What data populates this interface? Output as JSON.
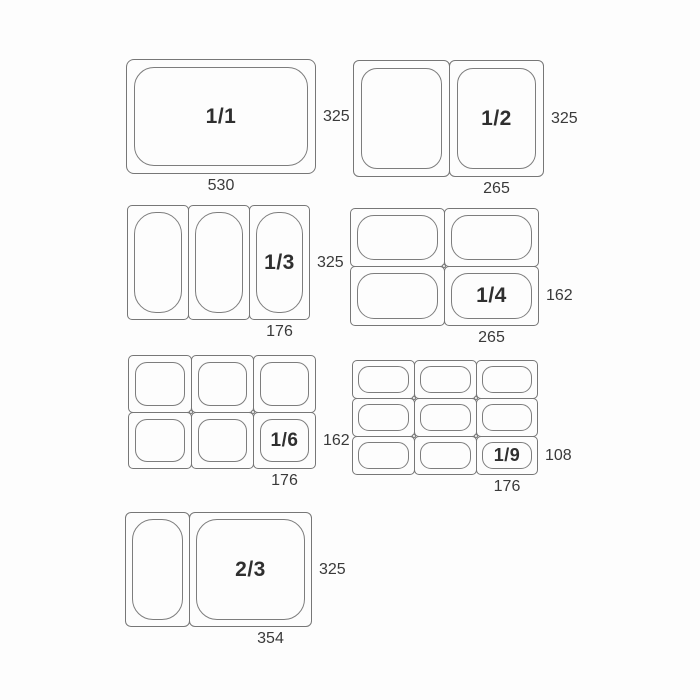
{
  "colors": {
    "line": "#777777",
    "label_text": "#2f2f2f",
    "dimension_text": "#3a3a3a",
    "background": "#fdfdfd"
  },
  "groups": [
    {
      "id": "1-1",
      "label": "1/1",
      "height_mm": "325",
      "width_mm": "530"
    },
    {
      "id": "1-2",
      "label": "1/2",
      "height_mm": "325",
      "width_mm": "265"
    },
    {
      "id": "1-3",
      "label": "1/3",
      "height_mm": "325",
      "width_mm": "176"
    },
    {
      "id": "1-4",
      "label": "1/4",
      "height_mm": "162",
      "width_mm": "265"
    },
    {
      "id": "1-6",
      "label": "1/6",
      "height_mm": "162",
      "width_mm": "176"
    },
    {
      "id": "1-9",
      "label": "1/9",
      "height_mm": "108",
      "width_mm": "176"
    },
    {
      "id": "2-3",
      "label": "2/3",
      "height_mm": "325",
      "width_mm": "354"
    }
  ]
}
